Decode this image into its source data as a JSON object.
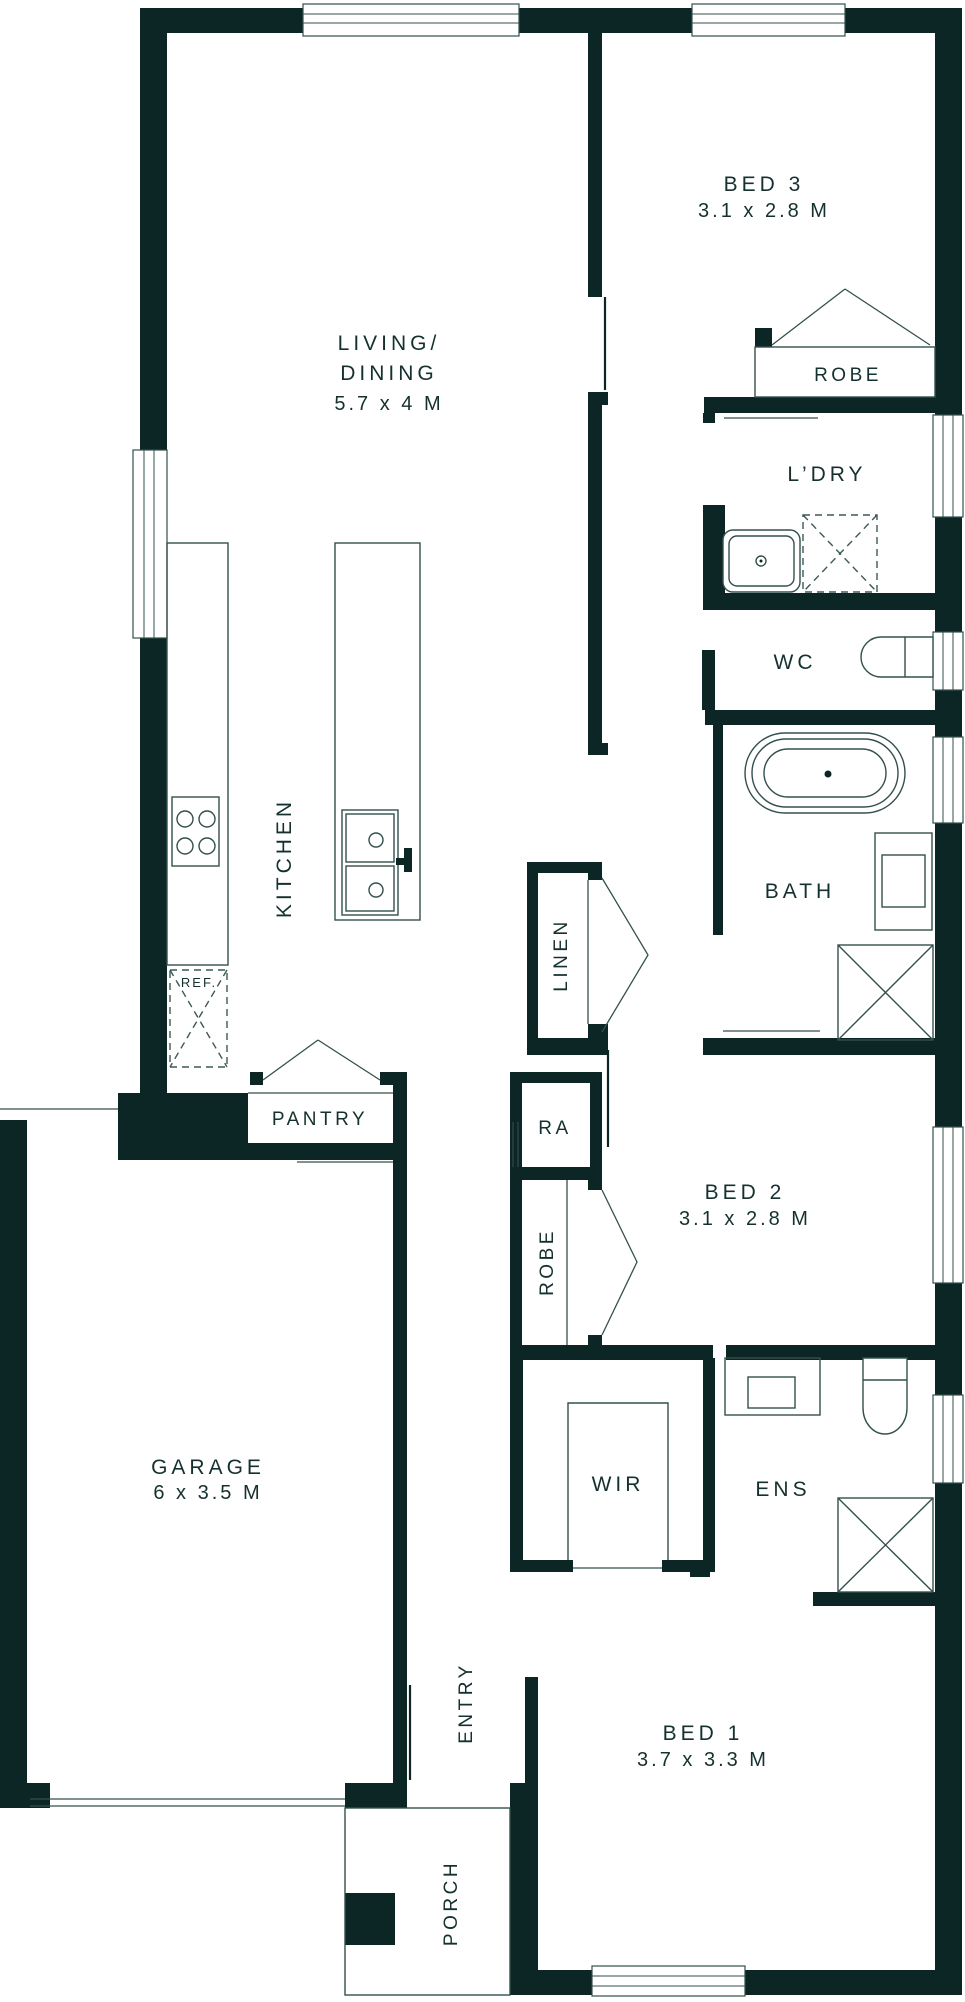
{
  "title": "Single storey house floor plan",
  "colors": {
    "wall": "#0c2625",
    "fixture_line": "#33504d",
    "text": "#15312f",
    "background": "#ffffff"
  },
  "rooms": {
    "living_dining": {
      "line1": "LIVING/",
      "line2": "DINING",
      "dims": "5.7 x 4 M"
    },
    "bed3": {
      "name": "BED 3",
      "dims": "3.1 x 2.8 M"
    },
    "bed2": {
      "name": "BED 2",
      "dims": "3.1 x 2.8 M"
    },
    "bed1": {
      "name": "BED 1",
      "dims": "3.7 x 3.3 M"
    },
    "garage": {
      "name": "GARAGE",
      "dims": "6 x 3.5 M"
    },
    "kitchen": {
      "name": "KITCHEN"
    },
    "laundry": {
      "name": "L’DRY"
    },
    "wc": {
      "name": "WC"
    },
    "bath": {
      "name": "BATH"
    },
    "ensuite": {
      "name": "ENS"
    },
    "wir": {
      "name": "WIR"
    },
    "entry": {
      "name": "ENTRY"
    },
    "porch": {
      "name": "PORCH"
    }
  },
  "closets": {
    "robe_bed3": "ROBE",
    "robe_bed2": "ROBE",
    "linen": "LINEN",
    "pantry": "PANTRY",
    "return_air": "RA",
    "fridge": "REF."
  }
}
